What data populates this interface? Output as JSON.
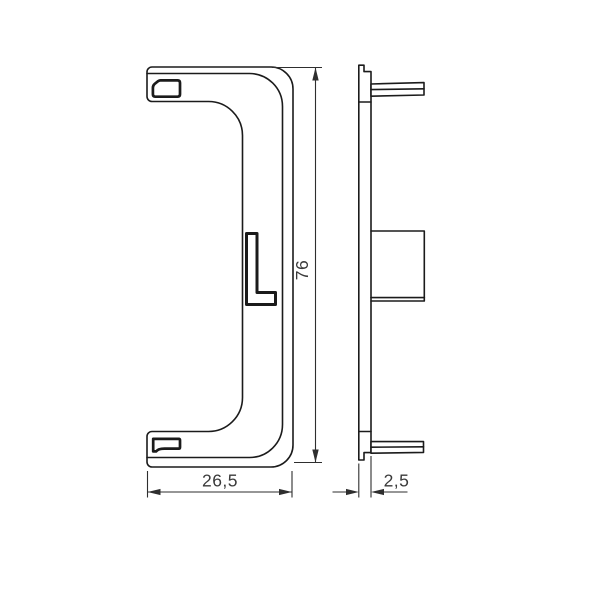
{
  "drawing": {
    "dimensions": {
      "height_label": "76",
      "width_label": "26,5",
      "thickness_label": "2,5"
    },
    "colors": {
      "part_line": "#1b1b1b",
      "dimension_line": "#2e2e2e",
      "text": "#3a3a3a",
      "background": "#ffffff"
    }
  }
}
